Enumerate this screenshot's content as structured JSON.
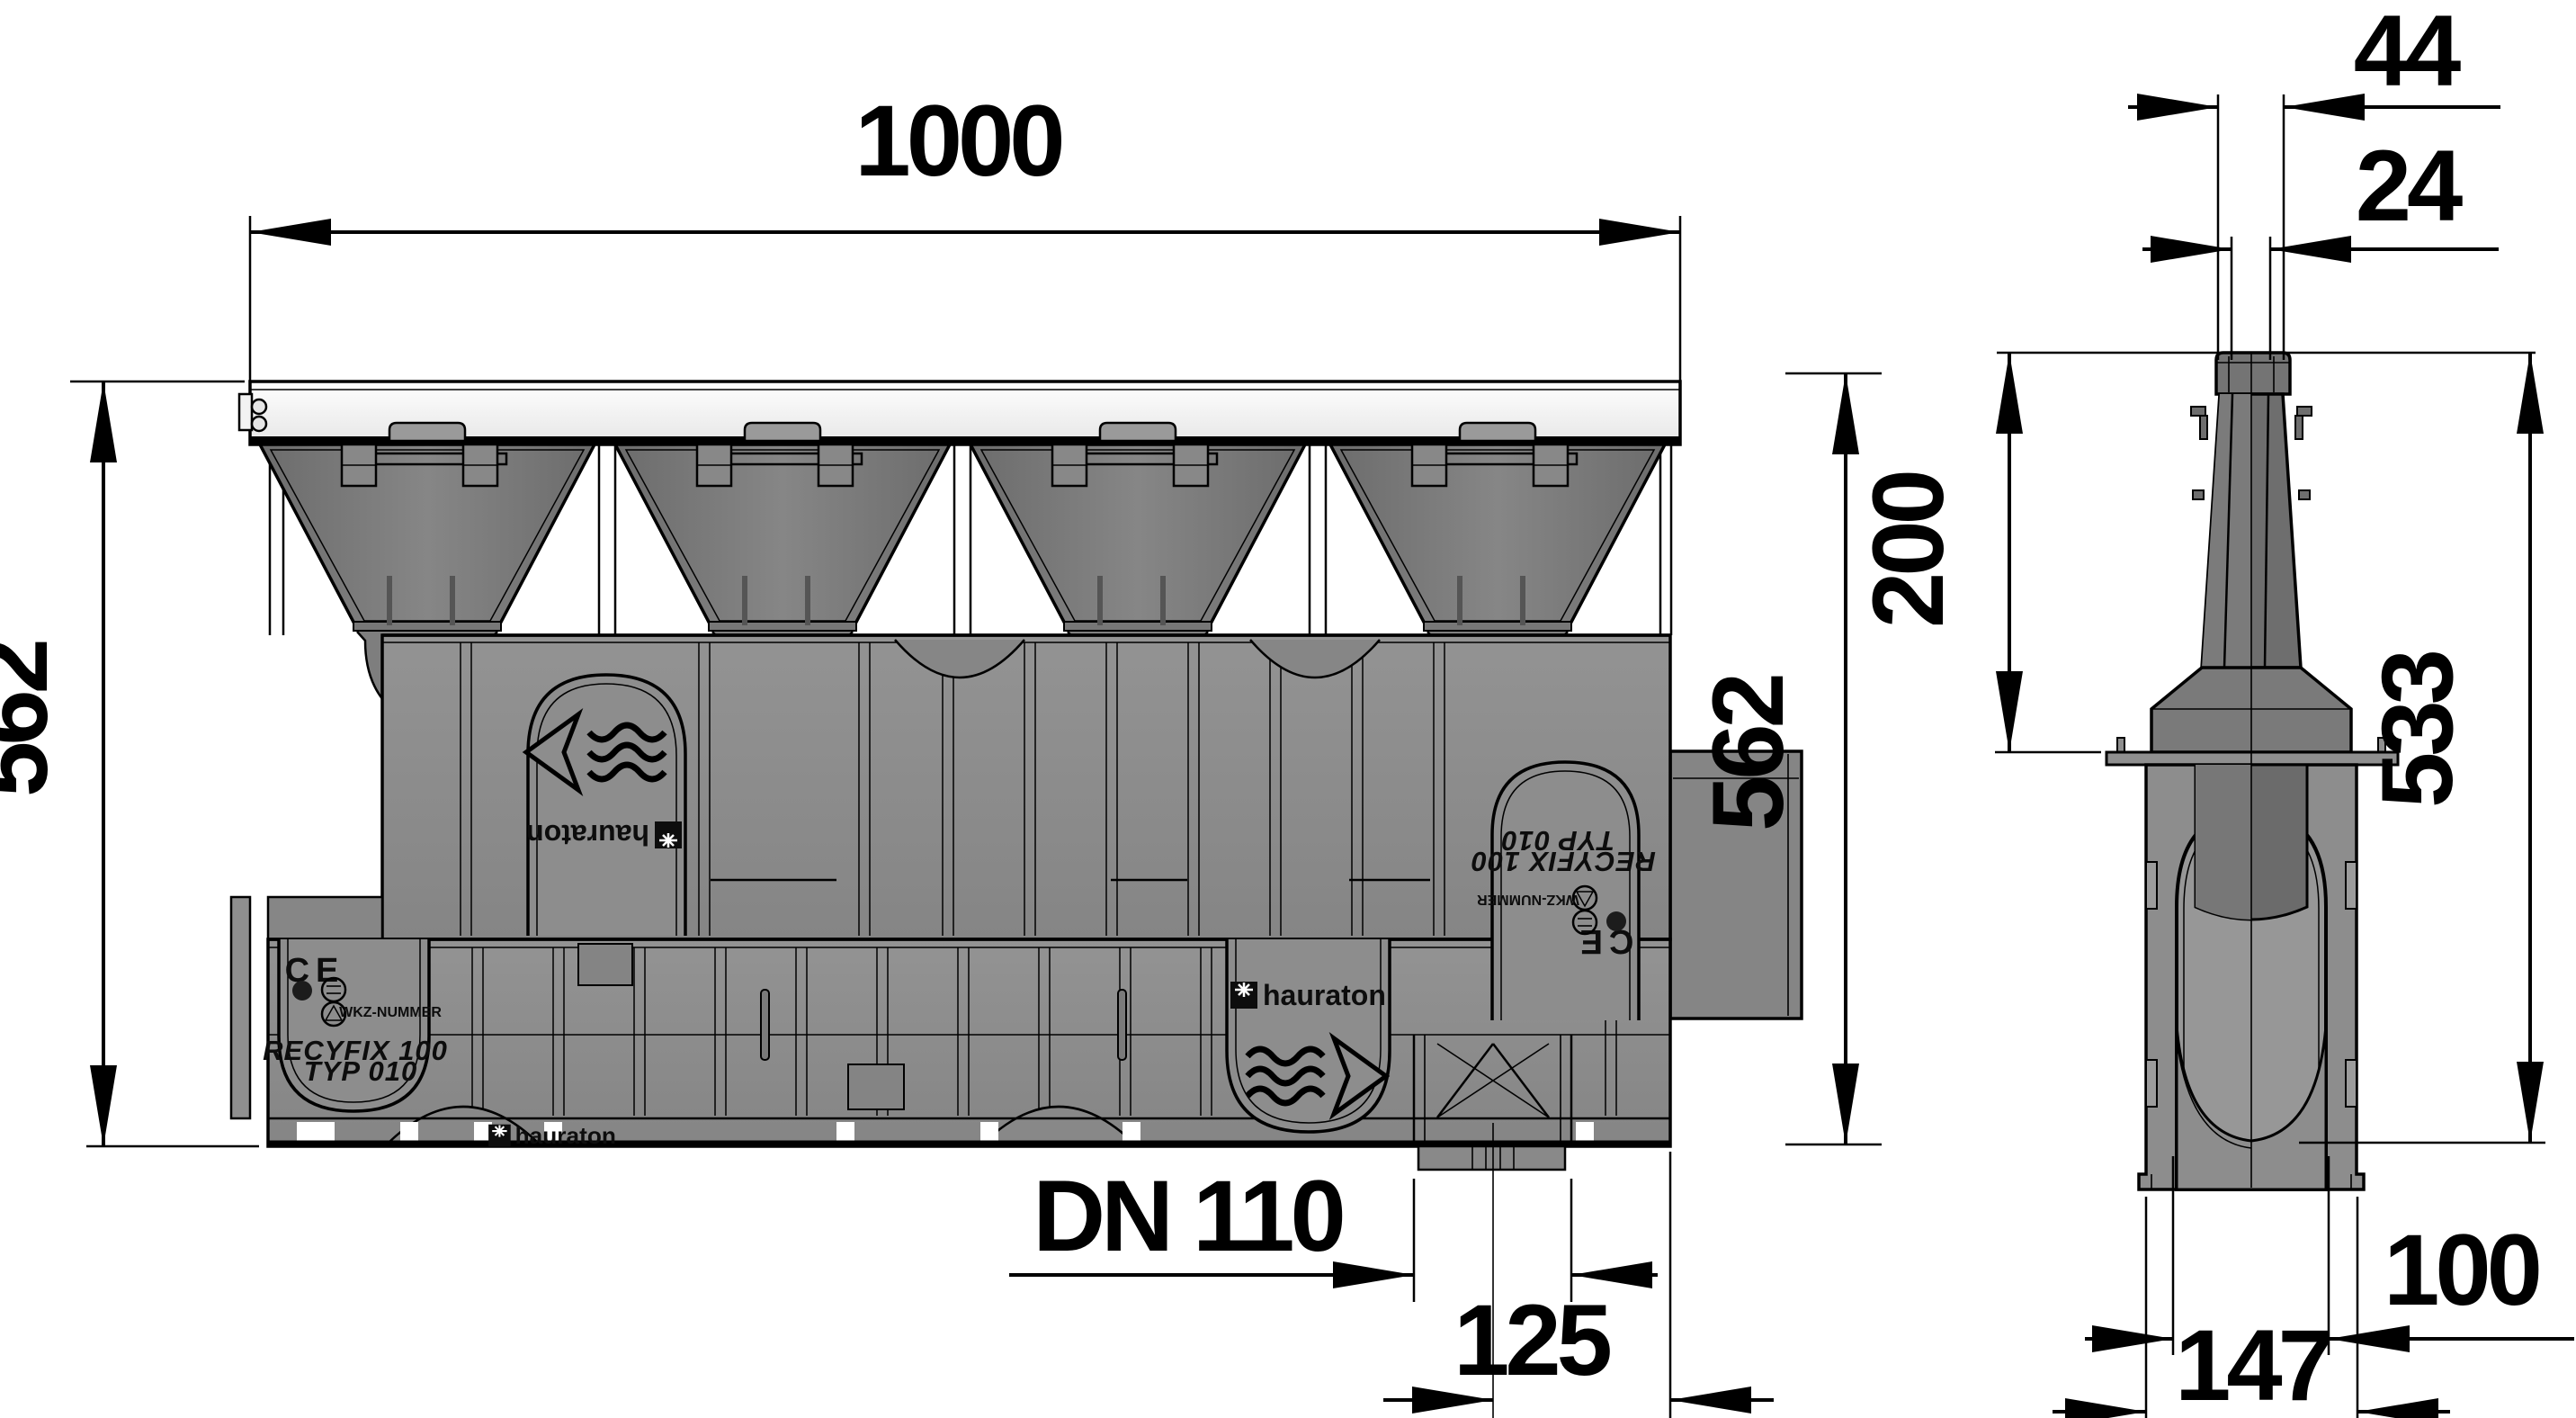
{
  "drawing": {
    "product": {
      "series": "RECYFIX 100",
      "type": "TYP 010",
      "brand": "hauraton",
      "wkz_label": "WKZ-NUMMER",
      "ce_label": "CE"
    },
    "front_view": {
      "width": "1000",
      "height_left": "562",
      "height_right": "562",
      "outlet_diameter": "DN 110",
      "outlet_end_offset": "125"
    },
    "side_view": {
      "slot_outer_width": "44",
      "slot_inner_width": "24",
      "slot_neck_height": "200",
      "channel_inner_height": "533",
      "channel_inner_width": "100",
      "channel_outer_width": "147"
    },
    "colors": {
      "background": "#ffffff",
      "line": "#000000",
      "body_gray": "#8d8d8d",
      "funnel_gray": "#7d7d7d",
      "neck_gray": "#6e6e6e",
      "grating_white": "#f7f7f7"
    }
  }
}
